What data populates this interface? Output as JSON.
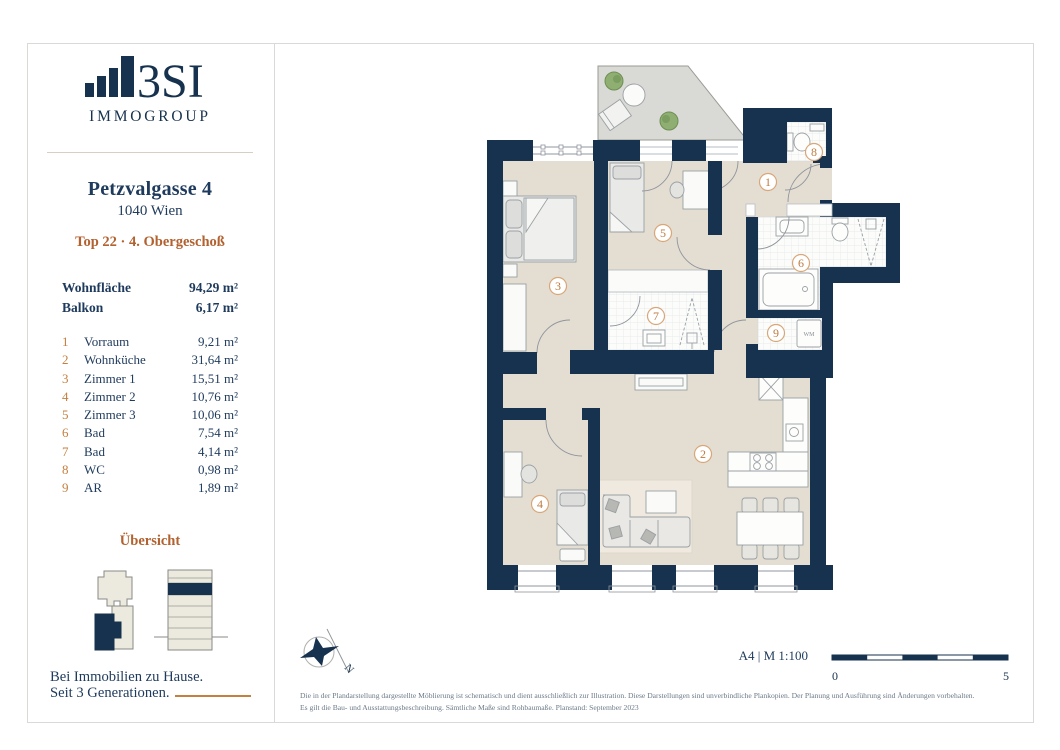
{
  "sidebar": {
    "logo": {
      "text": "3SI",
      "subtext": "IMMOGROUP"
    },
    "address": {
      "line1": "Petzvalgasse 4",
      "line2": "1040 Wien",
      "unit": "Top 22 · 4. Obergeschoß"
    },
    "summary": [
      {
        "label": "Wohnfläche",
        "value": "94,29 m²"
      },
      {
        "label": "Balkon",
        "value": "6,17 m²"
      }
    ],
    "rooms": [
      {
        "num": "1",
        "name": "Vorraum",
        "area": "9,21 m²"
      },
      {
        "num": "2",
        "name": "Wohnküche",
        "area": "31,64 m²"
      },
      {
        "num": "3",
        "name": "Zimmer 1",
        "area": "15,51 m²"
      },
      {
        "num": "4",
        "name": "Zimmer 2",
        "area": "10,76 m²"
      },
      {
        "num": "5",
        "name": "Zimmer 3",
        "area": "10,06 m²"
      },
      {
        "num": "6",
        "name": "Bad",
        "area": "7,54 m²"
      },
      {
        "num": "7",
        "name": "Bad",
        "area": "4,14 m²"
      },
      {
        "num": "8",
        "name": "WC",
        "area": "0,98 m²"
      },
      {
        "num": "9",
        "name": "AR",
        "area": "1,89 m²"
      }
    ],
    "overview_title": "Übersicht",
    "tagline_line1": "Bei Immobilien zu Hause.",
    "tagline_line2": "Seit 3 Generationen."
  },
  "plan": {
    "wm_label": "WM",
    "compass_label": "N"
  },
  "footer": {
    "format_scale": "A4 | M 1:100",
    "scale_start": "0",
    "scale_end": "5",
    "disclaimer_line1": "Die in der Plandarstellung dargestellte Möblierung ist schematisch und dient ausschließlich zur Illustration. Diese Darstellungen sind unverbindliche Plankopien. Der Planung und Ausführung sind Änderungen vorbehalten.",
    "disclaimer_line2": "Es gilt die Bau- und Ausstattungsbeschreibung. Sämtliche Maße sind Rohbaumaße. Planstand: September 2023"
  },
  "colors": {
    "navy": "#16324e",
    "rust": "#b2612f",
    "copper": "#c4803f",
    "floor_beige": "#e4ddd2",
    "balcony_gray": "#d9d9d5",
    "tile_white": "#fcfcfb",
    "label_circle": "#d9a677"
  }
}
